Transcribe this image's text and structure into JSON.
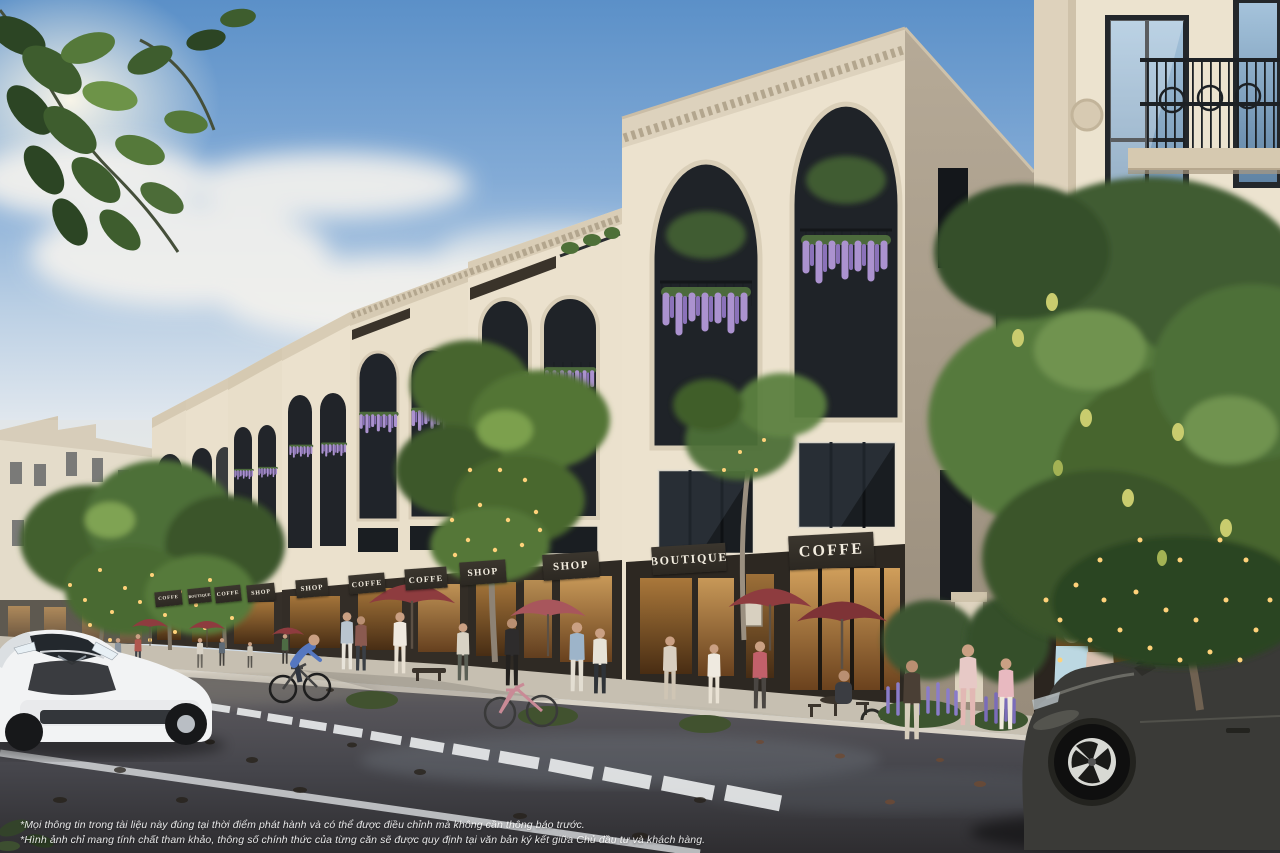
{
  "palette": {
    "sky_top": "#5b90c8",
    "sky_horizon": "#e3e9ef",
    "facade_cream": "#e9e0cc",
    "facade_shadow": "#b0a492",
    "sign_bg": "#3b362e",
    "sign_text": "#f2ecdf",
    "storefront_dark": "#2d2822",
    "storefront_glow": "#c08a46",
    "umbrella_red": "#8e3c3f",
    "foliage_green": "#4e7038",
    "wisteria_purple": "#b49bd8",
    "string_light_gold": "#ffd27a",
    "sidewalk": "#c6bfb1",
    "asphalt_dark": "#3a393d",
    "road_marking_white": "#e9ebec",
    "suv_gray": "#3a3a37",
    "car_white": "#f2f3f4",
    "disclaimer_text": "#ffffff"
  },
  "signs": [
    {
      "label": "COFFE"
    },
    {
      "label": "BOUTIQUE"
    },
    {
      "label": "COFFE"
    },
    {
      "label": "SHOP"
    },
    {
      "label": "SHOP"
    },
    {
      "label": "COFFE"
    },
    {
      "label": "COFFE"
    },
    {
      "label": "SHOP"
    },
    {
      "label": "SHOP"
    },
    {
      "label": "BOUTIQUE"
    },
    {
      "label": "COFFE"
    }
  ],
  "disclaimer": {
    "line1": "*Mọi thông tin trong tài liệu này đúng tại thời điểm phát hành và có thể được điều chỉnh mà không cần thông báo trước.",
    "line2": "*Hình ảnh chỉ mang tính chất tham khảo, thông số chính thức của từng căn sẽ được quy định tại văn bản ký kết giữa Chủ đầu tư và khách hàng."
  }
}
